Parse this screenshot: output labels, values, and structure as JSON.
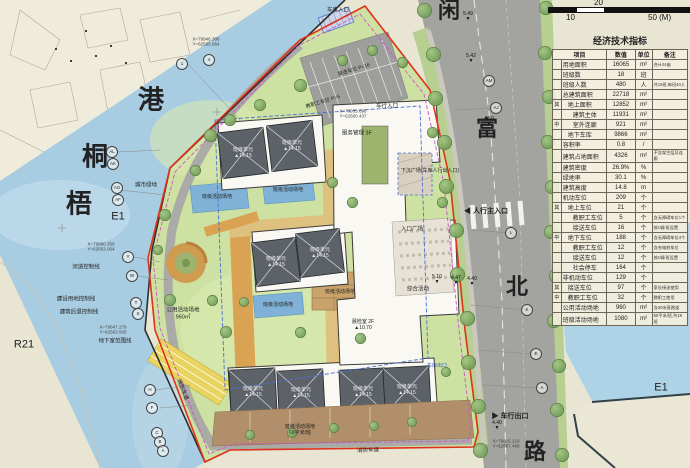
{
  "scale_bar": {
    "top": "20",
    "bottom_left": "10",
    "bottom_right": "50 (M)"
  },
  "table": {
    "title": "经济技术指标",
    "columns": [
      "项目",
      "数值",
      "单位",
      "备注"
    ],
    "rows": [
      {
        "p": "",
        "i": 0,
        "label": "用地面积",
        "value": "16065",
        "unit": "m²",
        "note": "合计24亩"
      },
      {
        "p": "",
        "i": 0,
        "label": "班级数",
        "value": "18",
        "unit": "班",
        "note": ""
      },
      {
        "p": "",
        "i": 0,
        "label": "班级人数",
        "value": "480",
        "unit": "人",
        "note": "共18班,每班40人"
      },
      {
        "p": "",
        "i": 0,
        "label": "总建筑面积",
        "value": "22718",
        "unit": "m²",
        "note": ""
      },
      {
        "p": "其",
        "i": 1,
        "label": "地上面积",
        "value": "12852",
        "unit": "m²",
        "note": ""
      },
      {
        "p": "",
        "i": 2,
        "label": "建筑主体",
        "value": "11931",
        "unit": "m²",
        "note": ""
      },
      {
        "p": "中",
        "i": 2,
        "label": "室外连廊",
        "value": "921",
        "unit": "m²",
        "note": ""
      },
      {
        "p": "",
        "i": 1,
        "label": "地下车库",
        "value": "9866",
        "unit": "m²",
        "note": ""
      },
      {
        "p": "",
        "i": 0,
        "label": "容积率",
        "value": "0.8",
        "unit": "/",
        "note": ""
      },
      {
        "p": "",
        "i": 0,
        "label": "建筑占地面积",
        "value": "4326",
        "unit": "m²",
        "note": "不含架空层及连廊"
      },
      {
        "p": "",
        "i": 0,
        "label": "建筑密度",
        "value": "26.9%",
        "unit": "%",
        "note": ""
      },
      {
        "p": "",
        "i": 0,
        "label": "绿地率",
        "value": "30.1",
        "unit": "%",
        "note": ""
      },
      {
        "p": "",
        "i": 0,
        "label": "建筑高度",
        "value": "14.8",
        "unit": "m",
        "note": ""
      },
      {
        "p": "",
        "i": 0,
        "label": "机动车位",
        "value": "209",
        "unit": "个",
        "note": ""
      },
      {
        "p": "其",
        "i": 1,
        "label": "地上车位",
        "value": "21",
        "unit": "个",
        "note": ""
      },
      {
        "p": "",
        "i": 2,
        "label": "教职工车位",
        "value": "5",
        "unit": "个",
        "note": "含无障碍车位1个"
      },
      {
        "p": "",
        "i": 2,
        "label": "接送车位",
        "value": "16",
        "unit": "个",
        "note": "按1辆/班设置"
      },
      {
        "p": "中",
        "i": 1,
        "label": "地下车位",
        "value": "188",
        "unit": "个",
        "note": "含无障碍车位4个"
      },
      {
        "p": "",
        "i": 2,
        "label": "教职工车位",
        "value": "12",
        "unit": "个",
        "note": "含充电桩车位"
      },
      {
        "p": "",
        "i": 2,
        "label": "接送车位",
        "value": "12",
        "unit": "个",
        "note": "按1辆/班设置"
      },
      {
        "p": "",
        "i": 2,
        "label": "社会停车",
        "value": "164",
        "unit": "个",
        "note": ""
      },
      {
        "p": "",
        "i": 0,
        "label": "非机动车位",
        "value": "129",
        "unit": "个",
        "note": ""
      },
      {
        "p": "其",
        "i": 1,
        "label": "接送车位",
        "value": "97",
        "unit": "个",
        "note": "家长接送使用"
      },
      {
        "p": "中",
        "i": 1,
        "label": "教职工车位",
        "value": "32",
        "unit": "个",
        "note": "教职工使用"
      },
      {
        "p": "",
        "i": 0,
        "label": "公用活动场地",
        "value": "960",
        "unit": "m²",
        "note": "含30米直跑道"
      },
      {
        "p": "",
        "i": 0,
        "label": "班级活动场地",
        "value": "1080",
        "unit": "m²",
        "note": "60平米/班,共18班"
      }
    ]
  },
  "map": {
    "labels": [
      {
        "t": "港",
        "x": 151,
        "y": 100,
        "s": 26,
        "f": 1
      },
      {
        "t": "桐",
        "x": 95,
        "y": 157,
        "s": 26,
        "f": 1
      },
      {
        "t": "梧",
        "x": 79,
        "y": 204,
        "s": 26,
        "f": 1
      },
      {
        "t": "闲",
        "x": 449,
        "y": 11,
        "s": 22,
        "f": 1
      },
      {
        "t": "富",
        "x": 487,
        "y": 129,
        "s": 22,
        "f": 1
      },
      {
        "t": "北",
        "x": 517,
        "y": 287,
        "s": 22,
        "f": 1
      },
      {
        "t": "路",
        "x": 535,
        "y": 452,
        "s": 22,
        "f": 1
      },
      {
        "t": "E1",
        "x": 118,
        "y": 217,
        "s": 11
      },
      {
        "t": "E1",
        "x": 661,
        "y": 388,
        "s": 11
      },
      {
        "t": "R21",
        "x": 24,
        "y": 345,
        "s": 11
      },
      {
        "t": "城市绿地",
        "x": 146,
        "y": 186,
        "s": 5.5
      },
      {
        "t": "河道控制线",
        "x": 86,
        "y": 268,
        "s": 5.5
      },
      {
        "t": "建设用地控制线",
        "x": 76,
        "y": 300,
        "s": 5.5
      },
      {
        "t": "建筑后退控制线",
        "x": 79,
        "y": 313,
        "s": 5.5
      },
      {
        "t": "地下室范围线",
        "x": 115,
        "y": 342,
        "s": 5.5
      },
      {
        "t": "消防车道",
        "x": 368,
        "y": 451,
        "s": 5.5,
        "r": -2
      },
      {
        "t": "消防车道",
        "x": 182,
        "y": 390,
        "s": 5.5,
        "r": 68
      },
      {
        "t": "公用活动场地\n960㎡",
        "x": 183,
        "y": 314,
        "s": 5.5
      },
      {
        "t": "班级活动场地",
        "x": 217,
        "y": 197,
        "s": 5
      },
      {
        "t": "班级活动场地",
        "x": 288,
        "y": 190,
        "s": 5
      },
      {
        "t": "班级活动场地",
        "x": 278,
        "y": 305,
        "s": 5
      },
      {
        "t": "班级活动场地",
        "x": 340,
        "y": 292,
        "s": 5
      },
      {
        "t": "班级活动场地\n60平米/班",
        "x": 300,
        "y": 430,
        "s": 5
      },
      {
        "t": "服务管理 3F",
        "x": 357,
        "y": 134,
        "s": 5.5
      },
      {
        "t": "综合活动",
        "x": 418,
        "y": 290,
        "s": 5.5
      },
      {
        "t": "晨检室 2F\n▲10.70",
        "x": 363,
        "y": 325,
        "s": 5
      },
      {
        "t": "入口广场",
        "x": 412,
        "y": 230,
        "s": 5.5
      },
      {
        "t": "下沉广场(车库人行出入口)",
        "x": 430,
        "y": 171,
        "s": 5
      },
      {
        "t": "◀ 人行主入口",
        "x": 486,
        "y": 212,
        "s": 7,
        "b": 1
      },
      {
        "t": "▶ 车行出口",
        "x": 510,
        "y": 417,
        "s": 7,
        "b": 1
      },
      {
        "t": "车库入口",
        "x": 338,
        "y": 11,
        "s": 5.5
      },
      {
        "t": "车行入口",
        "x": 387,
        "y": 107,
        "s": 5.5
      },
      {
        "t": "接送车位 P=16",
        "x": 354,
        "y": 70,
        "s": 5,
        "r": -17
      },
      {
        "t": "教职工车位 P=5",
        "x": 323,
        "y": 102,
        "s": 5,
        "r": -17
      },
      {
        "t": "车库出口",
        "x": 437,
        "y": 366,
        "s": 5,
        "c": "#3355bb"
      },
      {
        "t": "班级单元\n▲14.15",
        "x": 243,
        "y": 153,
        "s": 5,
        "c": "#f2f2f2"
      },
      {
        "t": "班级单元\n▲14.15",
        "x": 292,
        "y": 146,
        "s": 5,
        "c": "#f2f2f2"
      },
      {
        "t": "班级单元\n▲14.15",
        "x": 276,
        "y": 262,
        "s": 5,
        "c": "#f2f2f2"
      },
      {
        "t": "班级单元\n▲14.15",
        "x": 320,
        "y": 253,
        "s": 5,
        "c": "#f2f2f2"
      },
      {
        "t": "班级单元\n▲14.15",
        "x": 253,
        "y": 392,
        "s": 5,
        "c": "#f2f2f2"
      },
      {
        "t": "班级单元\n▲14.15",
        "x": 301,
        "y": 393,
        "s": 5,
        "c": "#f2f2f2"
      },
      {
        "t": "班级单元\n▲14.15",
        "x": 363,
        "y": 392,
        "s": 5,
        "c": "#f2f2f2"
      },
      {
        "t": "班级单元\n▲14.15",
        "x": 407,
        "y": 390,
        "s": 5,
        "c": "#f2f2f2"
      },
      {
        "t": "X=79946.386\nY=62585.564",
        "x": 206,
        "y": 42,
        "s": 4.5,
        "c": "#444"
      },
      {
        "t": "X=79880.350\nY=62563.064",
        "x": 101,
        "y": 247,
        "s": 4.5,
        "c": "#444"
      },
      {
        "t": "X=79847.279\nY=62563.505",
        "x": 113,
        "y": 330,
        "s": 4.5,
        "c": "#444"
      },
      {
        "t": "X=79935.698\nY=62660.437",
        "x": 353,
        "y": 114,
        "s": 4.5,
        "c": "#444"
      },
      {
        "t": "X=79815.219\nY=62687.486",
        "x": 506,
        "y": 444,
        "s": 4.5,
        "c": "#444"
      }
    ],
    "markers": [
      {
        "x": 182,
        "y": 64,
        "t": "1"
      },
      {
        "x": 209,
        "y": 60,
        "t": "4"
      },
      {
        "x": 112,
        "y": 152,
        "t": "AL"
      },
      {
        "x": 113,
        "y": 164,
        "t": "AK"
      },
      {
        "x": 117,
        "y": 188,
        "t": "AG"
      },
      {
        "x": 118,
        "y": 200,
        "t": "AF"
      },
      {
        "x": 128,
        "y": 257,
        "t": "Y"
      },
      {
        "x": 132,
        "y": 276,
        "t": "W"
      },
      {
        "x": 136,
        "y": 303,
        "t": "T"
      },
      {
        "x": 138,
        "y": 314,
        "t": "S"
      },
      {
        "x": 150,
        "y": 390,
        "t": "H"
      },
      {
        "x": 152,
        "y": 408,
        "t": "F"
      },
      {
        "x": 157,
        "y": 433,
        "t": "C"
      },
      {
        "x": 160,
        "y": 442,
        "t": "B"
      },
      {
        "x": 163,
        "y": 451,
        "t": "A"
      },
      {
        "x": 489,
        "y": 81,
        "t": "AM"
      },
      {
        "x": 496,
        "y": 108,
        "t": "AJ"
      },
      {
        "x": 511,
        "y": 233,
        "t": "L"
      },
      {
        "x": 527,
        "y": 310,
        "t": "K"
      },
      {
        "x": 536,
        "y": 354,
        "t": "E"
      },
      {
        "x": 542,
        "y": 388,
        "t": "A"
      }
    ],
    "elevations": [
      {
        "x": 468,
        "y": 22,
        "v": "5.49"
      },
      {
        "x": 471,
        "y": 64,
        "v": "5.42"
      },
      {
        "x": 489,
        "y": 127,
        "v": "4.50"
      },
      {
        "x": 437,
        "y": 285,
        "v": "5.10"
      },
      {
        "x": 456,
        "y": 286,
        "v": "4.47"
      },
      {
        "x": 472,
        "y": 287,
        "v": "4.40"
      },
      {
        "x": 497,
        "y": 431,
        "v": "4.40"
      }
    ]
  }
}
